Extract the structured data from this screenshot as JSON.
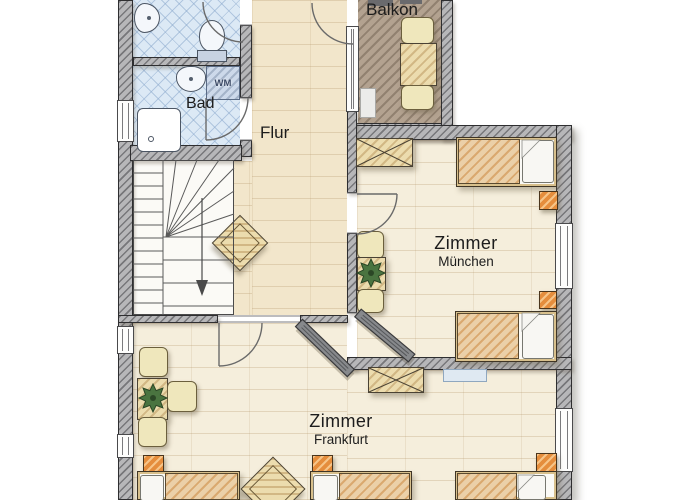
{
  "plan": {
    "rooms": {
      "bad": {
        "label": "Bad"
      },
      "flur": {
        "label": "Flur"
      },
      "balkon": {
        "label": "Balkon"
      },
      "zimmer_muenchen": {
        "label": "Zimmer",
        "sublabel": "München"
      },
      "zimmer_frankfurt": {
        "label": "Zimmer",
        "sublabel": "Frankfurt"
      }
    },
    "appliances": {
      "washing_machine_label": "WM"
    },
    "furniture_inventory": {
      "bad": [
        "sink",
        "washing-machine",
        "shower"
      ],
      "wc": [
        "sink",
        "toilet"
      ],
      "flur": [
        "staircase",
        "square-table"
      ],
      "balkon": [
        "table",
        "two-chairs",
        "planter-box"
      ],
      "zimmer_muenchen": [
        "wardrobe",
        "two-single-beds",
        "two-nightstands",
        "seating-table-with-plant",
        "window"
      ],
      "zimmer_frankfurt": [
        "wardrobe",
        "three-single-beds",
        "three-nightstands",
        "seating-table-with-plant",
        "square-table",
        "radiator",
        "windows"
      ]
    }
  },
  "colors": {
    "wall": "#b7b7b9",
    "wall_hatch": "#4c4c50",
    "floor_cream": "#f5eedc",
    "floor_flur": "#f2e6cb",
    "tile_blue": "#dce9f5",
    "balcony_floor": "#b3a290",
    "wood": "#ecdcae",
    "mattress": "#ebd0a8",
    "nightstand": "#e58d3c",
    "chair": "#efe7bc",
    "plant": "#4a7440",
    "door_panel": "#87898c",
    "text": "#1c1c1c"
  }
}
